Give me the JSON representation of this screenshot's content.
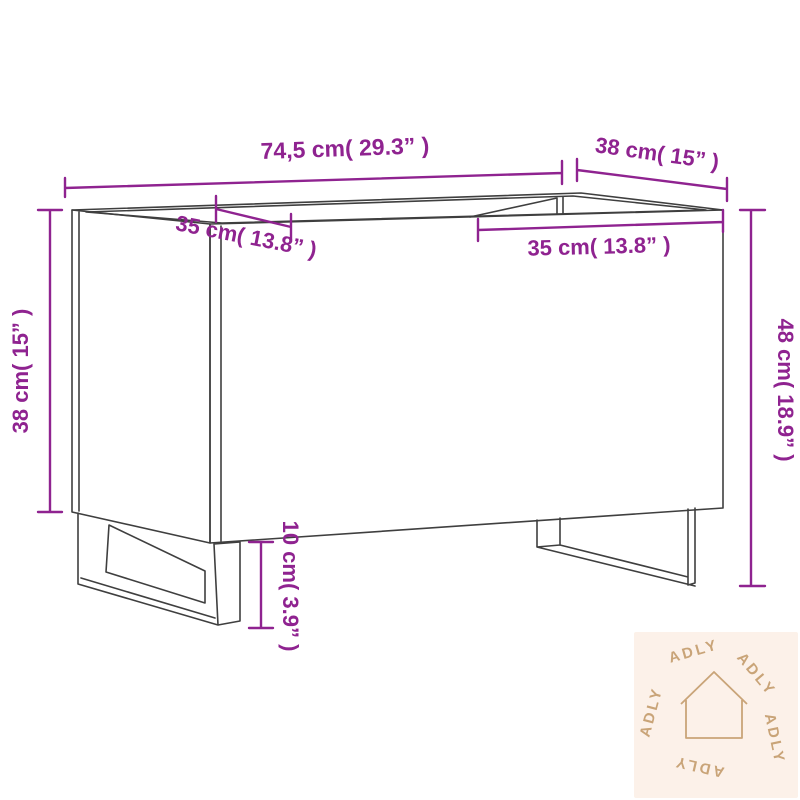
{
  "diagram": {
    "type": "product-dimension-diagram",
    "labels": {
      "overall_width": "74,5 cm( 29.3” )",
      "depth": "38 cm( 15” )",
      "left_compartment_width": "35 cm( 13.8” )",
      "right_compartment_width": "35 cm( 13.8” )",
      "body_height": "38 cm( 15” )",
      "total_height": "48 cm( 18.9” )",
      "leg_height": "10 cm( 3.9” )"
    },
    "colors": {
      "dimension": "#8F2390",
      "line": "#3F3F3F",
      "watermark_bg": "#FCF1E9",
      "watermark_fg": "#C9A478"
    },
    "watermark": {
      "brand": "ADLY"
    }
  }
}
